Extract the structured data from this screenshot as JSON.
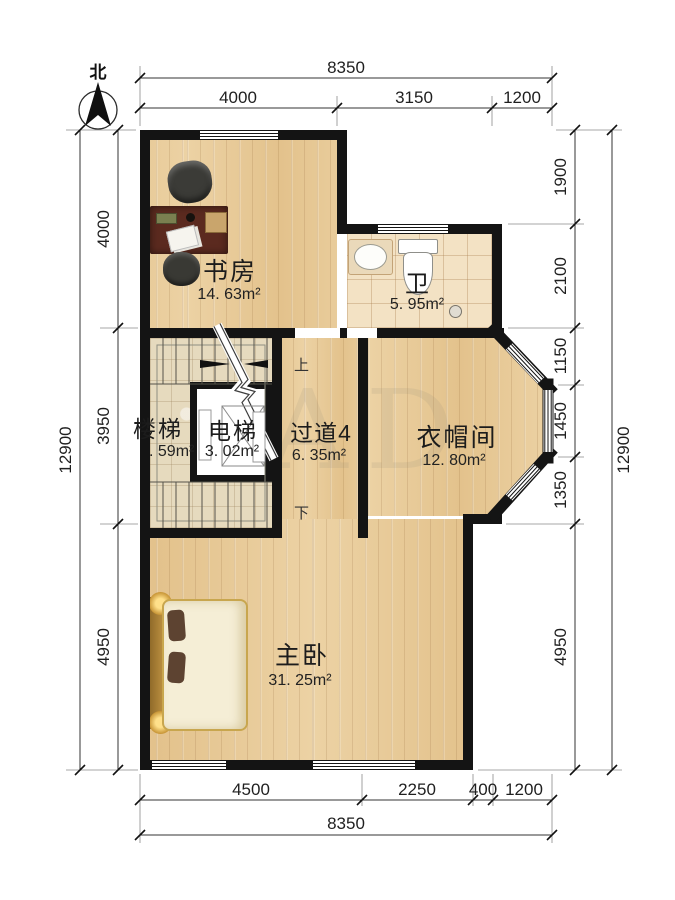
{
  "compass": {
    "label": "北"
  },
  "rooms": {
    "study": {
      "name": "书房",
      "area": "14. 63m²"
    },
    "bath": {
      "name": "卫",
      "area": "5. 95m²"
    },
    "stairs": {
      "name": "楼梯",
      "area": ". 59m²"
    },
    "elevator": {
      "name": "电梯",
      "area": "3. 02m²"
    },
    "hallway": {
      "name": "过道4",
      "area": "6. 35m²"
    },
    "closet": {
      "name": "衣帽间",
      "area": "12. 80m²"
    },
    "master": {
      "name": "主卧",
      "area": "31. 25m²"
    }
  },
  "stair_marks": {
    "up": "上",
    "down": "下"
  },
  "dimensions": {
    "top": {
      "total": "8350",
      "segments": [
        "4000",
        "3150",
        "1200"
      ]
    },
    "bottom": {
      "total": "8350",
      "segments": [
        "4500",
        "2250",
        "400",
        "1200"
      ]
    },
    "left": {
      "total": "12900",
      "segments": [
        "4000",
        "3950",
        "4950"
      ]
    },
    "right": {
      "total": "12900",
      "segments": [
        "1900",
        "2100",
        "1150",
        "1450",
        "1350",
        "4950"
      ]
    }
  },
  "watermark": {
    "text": "AD"
  },
  "colors": {
    "wall": "#141414",
    "wood": "#e8c893",
    "tile": "#f3e2c4",
    "marble": "#e6dabe"
  }
}
